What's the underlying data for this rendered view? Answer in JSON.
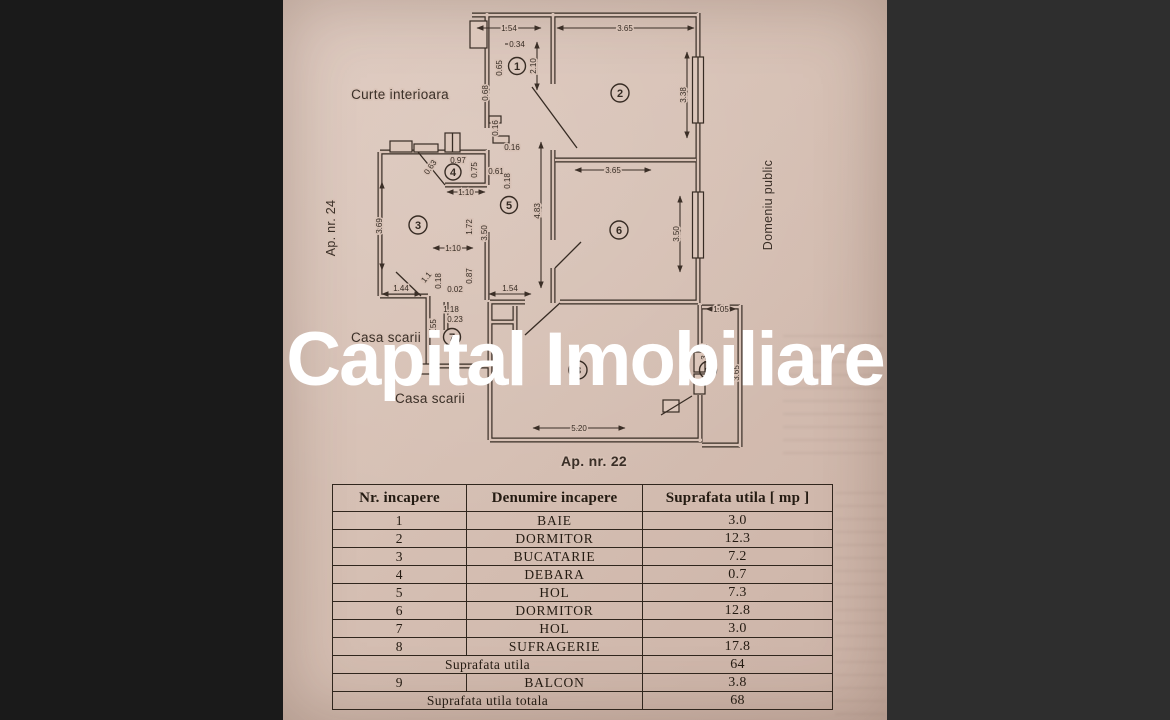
{
  "watermark": {
    "text": "Capital Imobiliare",
    "color": "#ffffff"
  },
  "plan": {
    "labels": {
      "curte": "Curte interioara",
      "ap24": "Ap. nr. 24",
      "domeniu": "Domeniu public",
      "casa_scarii_1": "Casa scarii",
      "casa_scarii_2": "Casa scarii",
      "ap22": "Ap. nr. 22"
    },
    "rooms": {
      "r1": "1",
      "r2": "2",
      "r3": "3",
      "r4": "4",
      "r5": "5",
      "r6": "6",
      "r7": "7",
      "r8": "8",
      "r9": "9"
    },
    "dims": {
      "t154": "1.54",
      "t365": "3.65",
      "d034": "0.34",
      "d065": "0.65",
      "d210": "2.10",
      "d068": "0.68",
      "d338": "3.38",
      "d016v": "0.16",
      "d016h": "0.16",
      "d097": "0.97",
      "d063": "0.63",
      "d075": "0.75",
      "d061": "0.61",
      "d018a": "0.18",
      "d110a": "1.10",
      "d369": "3.69",
      "d172": "1.72",
      "d350a": "3.50",
      "d483": "4.83",
      "t365b": "3.65",
      "d350b": "3.50",
      "d110b": "1.10",
      "d11": "1.1",
      "d018b": "0.18",
      "d087": "0.87",
      "d144": "1.44",
      "d002": "0.02",
      "d154b": "1.54",
      "d118": "1.18",
      "d023": "0.23",
      "d355": "3.55",
      "d105": "1.05",
      "d342": "3.42",
      "d365c": "3.65",
      "d520": "5.20"
    }
  },
  "table": {
    "headers": [
      "Nr. incapere",
      "Denumire  incapere",
      "Suprafata utila [ mp ]"
    ],
    "rows": [
      {
        "nr": "1",
        "denumire": "BAIE",
        "suprafata": "3.0"
      },
      {
        "nr": "2",
        "denumire": "DORMITOR",
        "suprafata": "12.3"
      },
      {
        "nr": "3",
        "denumire": "BUCATARIE",
        "suprafata": "7.2"
      },
      {
        "nr": "4",
        "denumire": "DEBARA",
        "suprafata": "0.7"
      },
      {
        "nr": "5",
        "denumire": "HOL",
        "suprafata": "7.3"
      },
      {
        "nr": "6",
        "denumire": "DORMITOR",
        "suprafata": "12.8"
      },
      {
        "nr": "7",
        "denumire": "HOL",
        "suprafata": "3.0"
      },
      {
        "nr": "8",
        "denumire": "SUFRAGERIE",
        "suprafata": "17.8"
      }
    ],
    "subtotal_label": "Suprafata utila",
    "subtotal_value": "64",
    "balcon_row": {
      "nr": "9",
      "denumire": "BALCON",
      "suprafata": "3.8"
    },
    "total_label": "Suprafata utila totala",
    "total_value": "68"
  }
}
